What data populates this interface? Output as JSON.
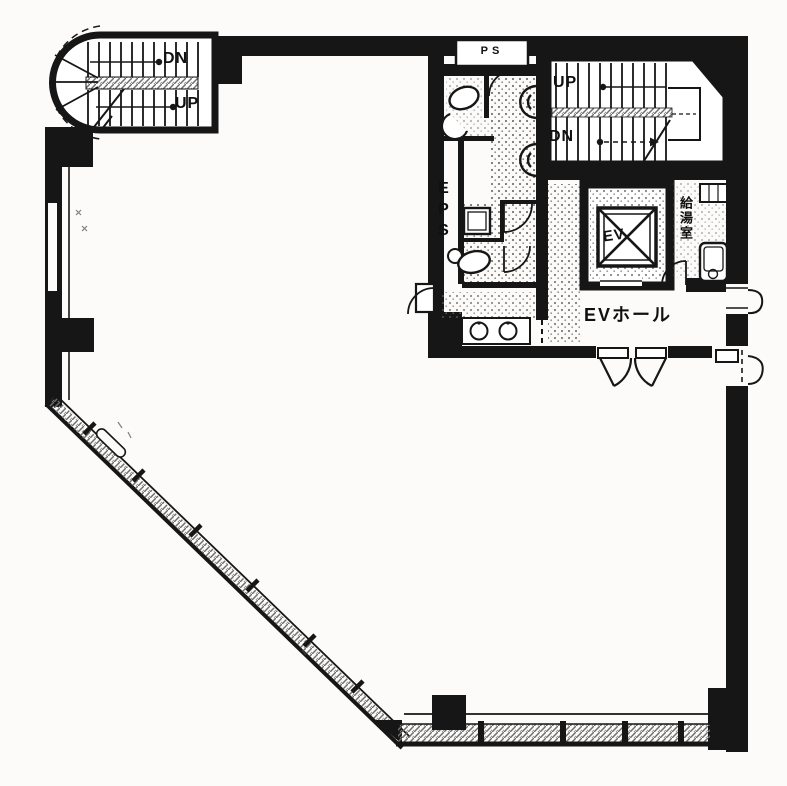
{
  "plan": {
    "labels": {
      "stair_left_dn": "DN",
      "stair_left_up": "UP",
      "stair_right_up": "UP",
      "stair_right_dn": "DN",
      "pipe_shaft": "PS",
      "electrical_shaft": "EPS",
      "elevator": "EV",
      "kitchenette": "給湯室",
      "elevator_hall": "EVホール"
    },
    "colors": {
      "ink": "#161616",
      "paper": "#fcfbf9",
      "stipple": "#5e5e5e",
      "hatch": "#6e6e6e"
    }
  }
}
